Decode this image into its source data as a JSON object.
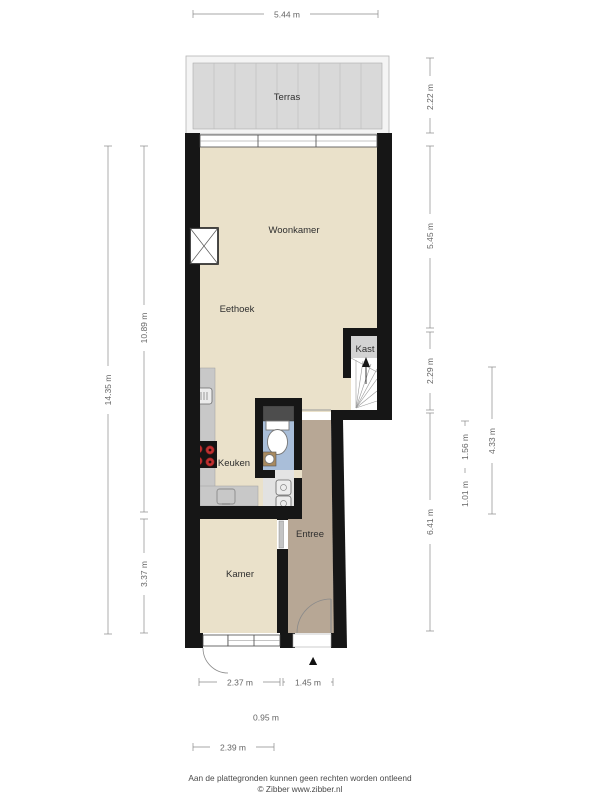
{
  "plan": {
    "rooms": {
      "terras": "Terras",
      "woonkamer": "Woonkamer",
      "eethoek": "Eethoek",
      "kast": "Kast",
      "keuken": "Keuken",
      "entree": "Entree",
      "kamer": "Kamer"
    },
    "dimensions": {
      "top_width": "5.44 m",
      "left_total_height": "14.35 m",
      "left_upper_height": "10.89 m",
      "left_lower_height": "3.37 m",
      "right_terrace_height": "2.22 m",
      "right_woonkamer_height": "5.45 m",
      "right_stairs_height": "2.29 m",
      "right_lower_height": "6.41 m",
      "right_inner_upper": "1.56 m",
      "right_inner_lower": "1.01 m",
      "right_inner_total": "4.33 m",
      "bottom_kamer_width": "2.37 m",
      "bottom_entree_width": "1.45 m",
      "bottom_door_width": "0.95 m",
      "bottom_lower_width": "2.39 m"
    },
    "icons": {
      "entrance_marker": "▲"
    },
    "colors": {
      "wall": "#161616",
      "floor_main": "#eae1ca",
      "floor_entree": "#b7a795",
      "floor_toilet": "#a9bed9",
      "floor_kast": "#d3d3d3",
      "floor_closet": "#e2e2e2",
      "floor_terrace": "#d9d9d9",
      "terrace_frame": "#f4f4f4",
      "counter": "#c8c8c8",
      "cabinet_dark": "#4d4d4d",
      "burner_red": "#c03030",
      "appliance": "#ececec",
      "sink_base": "#a98a5f"
    }
  },
  "footer": {
    "disclaimer": "Aan de plattegronden kunnen geen rechten worden ontleend",
    "credit": "© Zibber www.zibber.nl"
  }
}
